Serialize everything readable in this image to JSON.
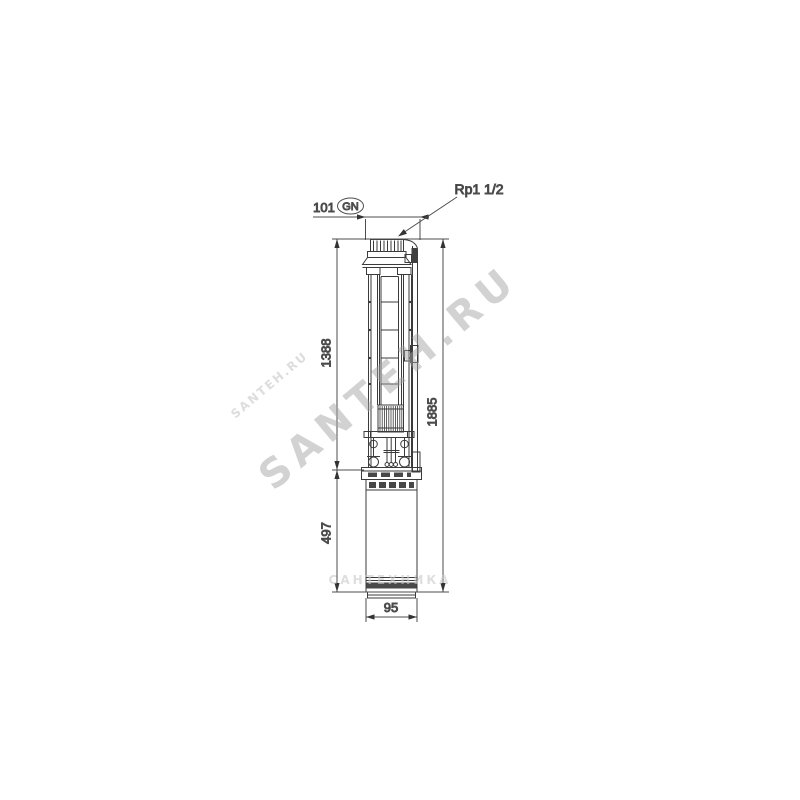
{
  "labels": {
    "connection": "Rp1 1/2",
    "gn": "GN"
  },
  "dims": {
    "width_top": "101",
    "pump": "1388",
    "total": "1885",
    "motor": "497",
    "diameter": "95"
  },
  "watermark": {
    "main": "SANTEH.RU",
    "fragment": "SANTEH.RU",
    "strip": "САНТЕХНИКА"
  },
  "colors": {
    "line": "#3b3b3b",
    "dim_line": "#4d4d4d",
    "text": "#373737",
    "watermark": "#a2a2a2",
    "background": "#ffffff"
  }
}
